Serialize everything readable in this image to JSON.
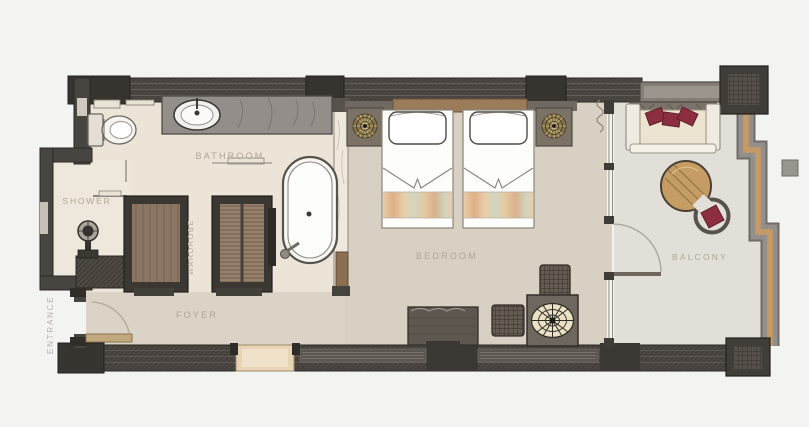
{
  "title": "Hotel guestroom floor plan",
  "rooms": {
    "bathroom": {
      "label": "BATHROOM"
    },
    "shower": {
      "label": "SHOWER"
    },
    "wardrobe": {
      "label": "WARDROBE"
    },
    "foyer": {
      "label": "FOYER"
    },
    "bedroom": {
      "label": "BEDROOM"
    },
    "balcony": {
      "label": "BALCONY"
    },
    "entrance": {
      "label": "ENTRANCE"
    }
  },
  "fixtures": [
    "toilet",
    "vanity-washbasin",
    "freestanding-bathtub",
    "shower-head",
    "wardrobe-closet-left",
    "wardrobe-closet-right",
    "twin-bed-left",
    "twin-bed-right",
    "nightstand-left",
    "nightstand-right",
    "bench",
    "ottoman-upper",
    "ottoman-lower",
    "radial-side-table",
    "balcony-daybed",
    "balcony-round-table",
    "balcony-armchair"
  ],
  "colors": {
    "background": "#f3f3f1",
    "wall": "#4c4742",
    "wall_dark_block": "#37332e",
    "floor_bathroom": "#ebe4d7",
    "floor_bedroom": "#d8d0c2",
    "floor_foyer": "#dbd3c5",
    "floor_balcony": "#e2dfd9",
    "headboard_wood": "#9a7c58",
    "wardrobe_wood": "#8b7663",
    "accent_maroon": "#8c2e40",
    "accent_gold": "#c9b06a",
    "table_wood": "#c59c64",
    "railing_gray": "#93908b",
    "railing_tan": "#c69a66",
    "label_color": "#b1a695"
  }
}
